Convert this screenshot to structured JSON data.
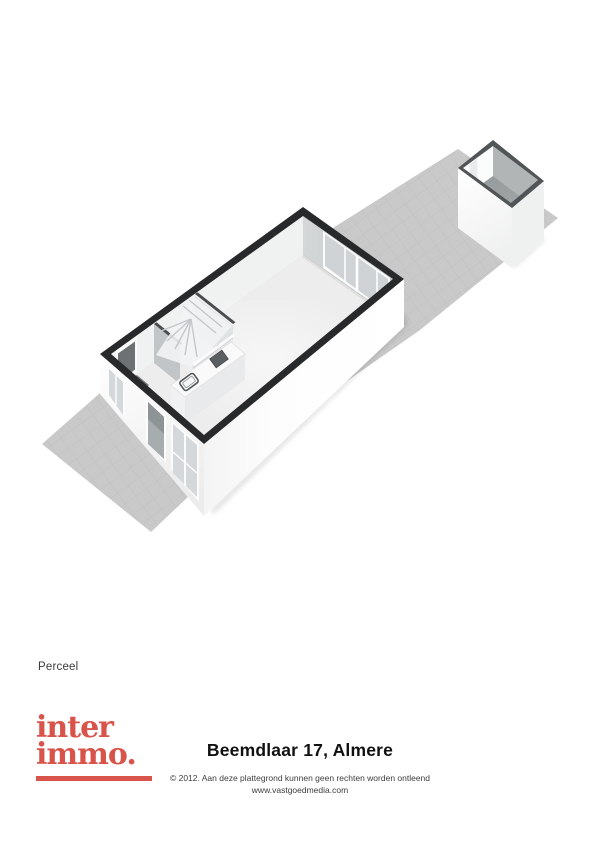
{
  "page": {
    "background": "#ffffff"
  },
  "plan": {
    "label": "Perceel"
  },
  "branding": {
    "logo_line1": "inter",
    "logo_line2": "immo.",
    "logo_color": "#d8534a"
  },
  "footer": {
    "title": "Beemdlaar 17, Almere",
    "copyright_line1": "© 2012. Aan deze plattegrond kunnen geen rechten worden ontleend",
    "copyright_line2": "www.vastgoedmedia.com"
  },
  "colors": {
    "plot_gray": "#c9c9c9",
    "exterior_wall_cut": "#28292a",
    "interior_wall_cut": "#4a4d4f",
    "shed_wall_cut": "#515557",
    "house_floor": "#ededed",
    "shed_floor": "#9ea2a2",
    "glass": "#d4d8da",
    "wall_white": "#fdfdfd"
  }
}
